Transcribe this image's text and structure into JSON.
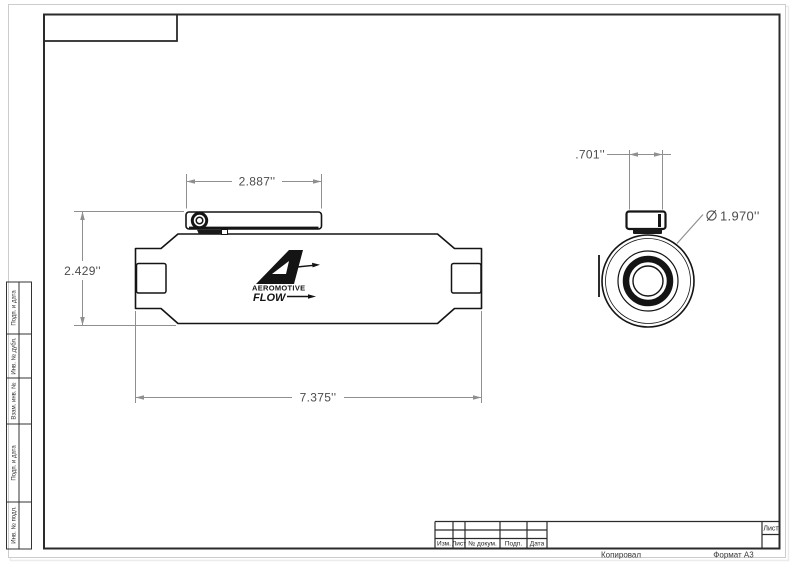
{
  "page": {
    "type": "technical-drawing",
    "paper_format": "A3"
  },
  "drawing": {
    "logo": {
      "brand": "AEROMOTIVE",
      "flow_label": "FLOW"
    },
    "dimensions": {
      "bracket_length": "2.887''",
      "overall_height": "2.429''",
      "overall_length": "7.375''",
      "port_offset": ".701''",
      "diameter_symbol": "⌀",
      "diameter_value": "1.970''"
    }
  },
  "title_block": {
    "columns": [
      "Изм.",
      "Лист",
      "№ докум.",
      "Подп.",
      "Дата"
    ],
    "sheet_label": "Лист"
  },
  "margin": {
    "labels": [
      "Подп. и дата",
      "Инв. № дубл.",
      "Взам. инв. №",
      "Подп. и дата",
      "Инв. № подл."
    ]
  },
  "footer": {
    "copy_label": "Копировал",
    "format_label": "Формат А3"
  },
  "colors": {
    "outline": "#141414",
    "frame": "#2b2b2b",
    "dimension_line": "#8f8f8f",
    "dimension_text": "#4c4c4c",
    "sheet_border": "#cccccc"
  }
}
